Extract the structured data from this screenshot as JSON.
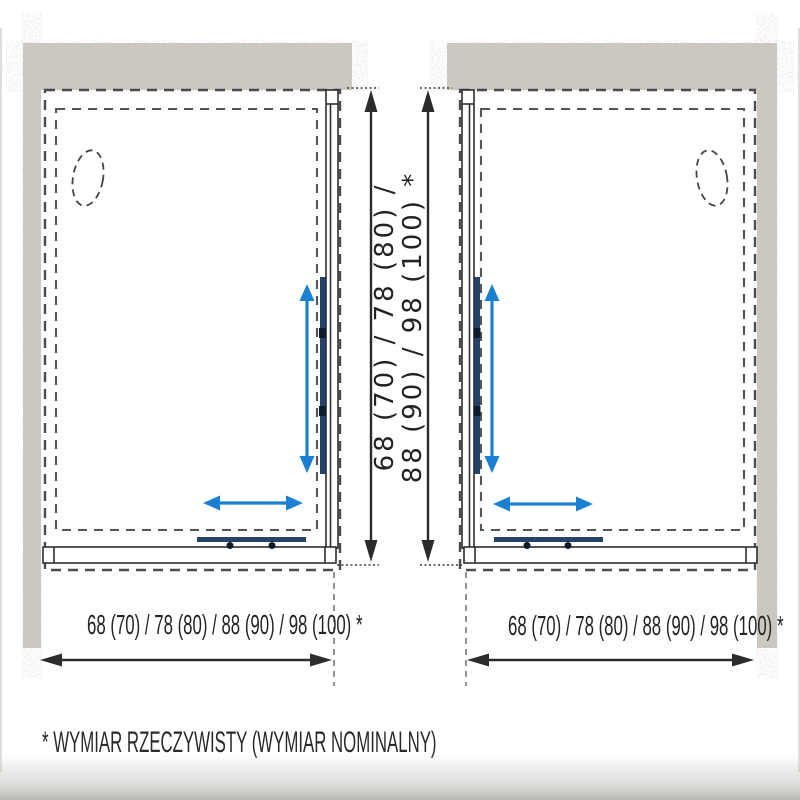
{
  "drawings": {
    "left": {
      "width_label": "68 (70) / 78 (80) / 88 (90) / 98 (100) *"
    },
    "right": {
      "width_label": "68 (70) / 78 (80) / 88 (90) / 98 (100) *"
    },
    "height_label_lines": [
      "68 (70) / 78 (80) /",
      "88 (90) / 98 (100) *"
    ]
  },
  "footnote": "* WYMIAR RZECZYWISTY (WYMIAR NOMINALNY)",
  "colors": {
    "line": "#2e2e2e",
    "dashed_outline": "#4c4c4c",
    "blue_arrow": "#1b7fd2",
    "door_bar": "#25426a",
    "roller": "#0d1b2b",
    "wall_base": "#ccc8c0",
    "text": "#232323"
  }
}
